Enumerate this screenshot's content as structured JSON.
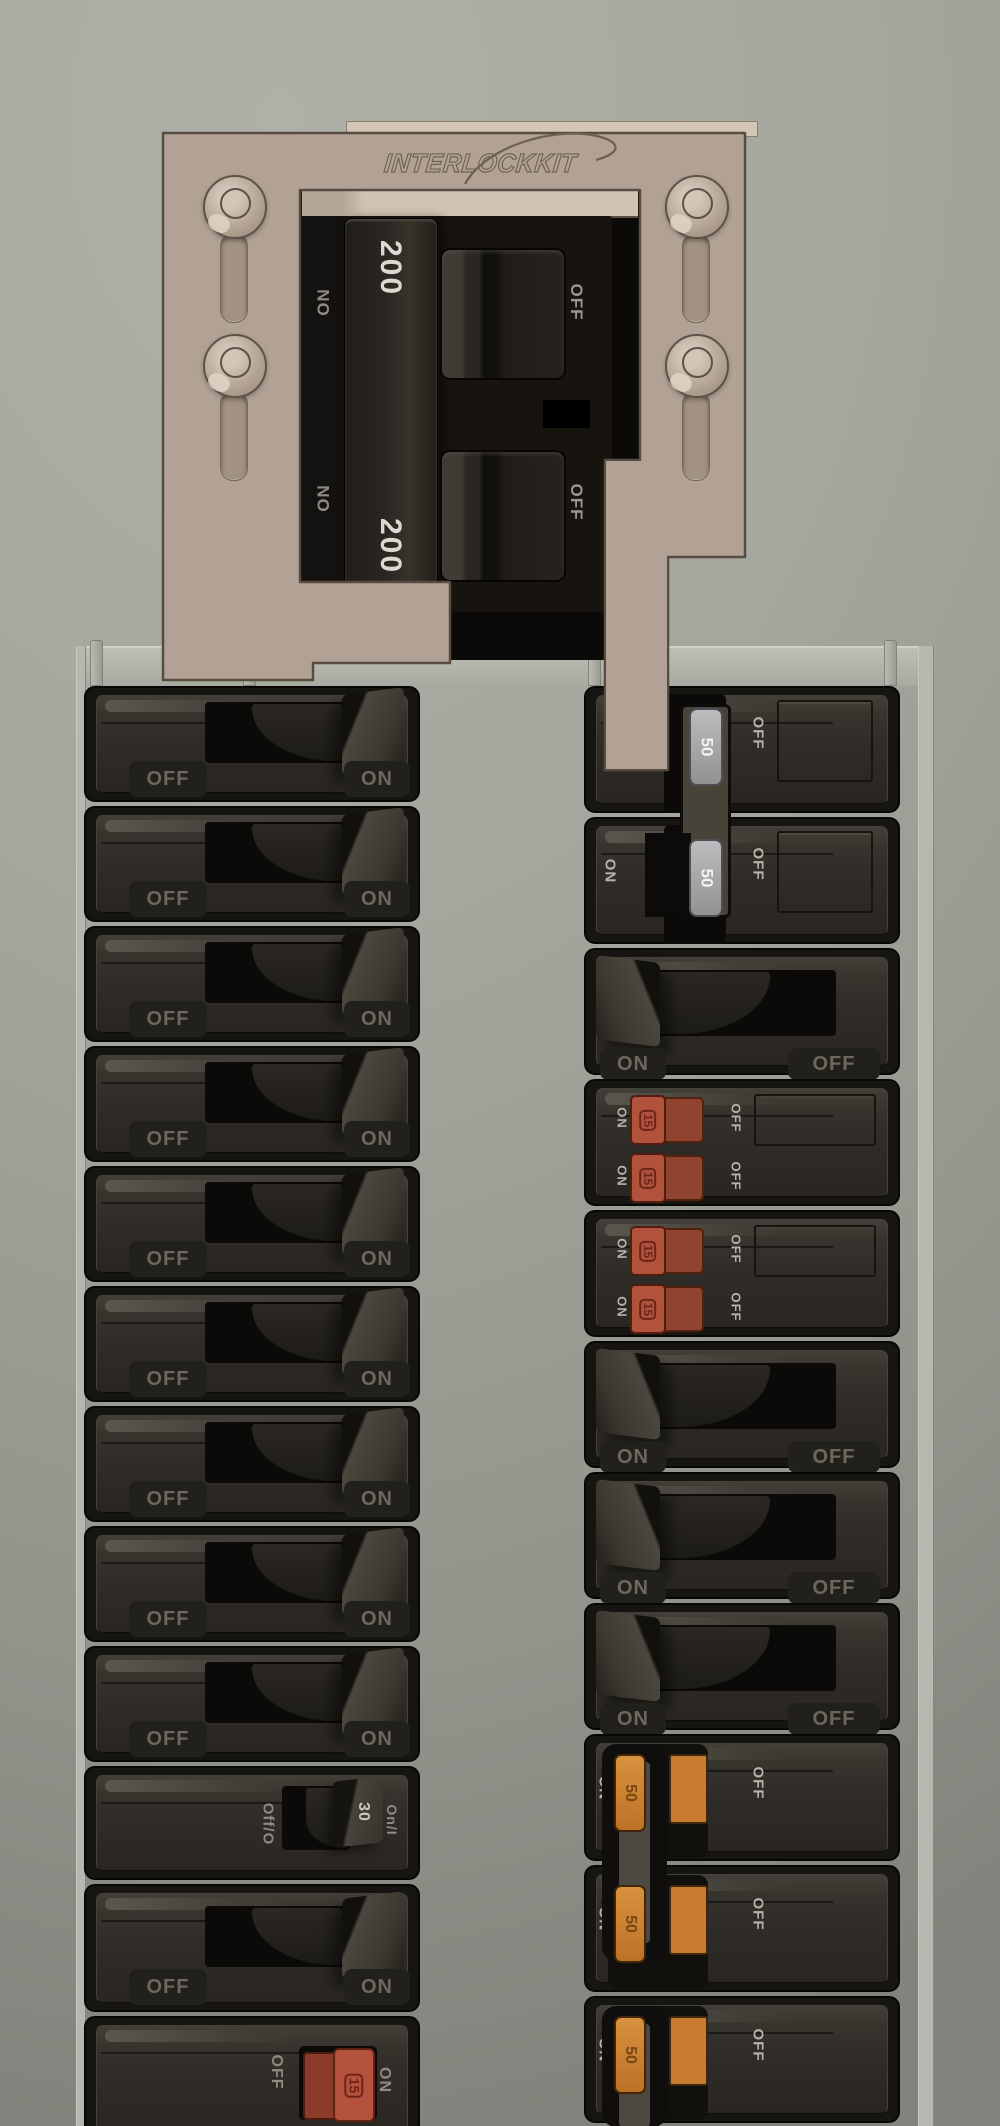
{
  "panel": {
    "interlock_kit": {
      "brand": "INTERLOCKKIT",
      "main_breaker": {
        "pole1": {
          "on": "ON",
          "amps": "200",
          "off": "OFF"
        },
        "pole2": {
          "on": "ON",
          "amps": "200",
          "off": "OFF"
        }
      }
    },
    "left_column": {
      "rows": [
        {
          "type": "single",
          "off": "OFF",
          "on": "ON",
          "state": "on"
        },
        {
          "type": "single",
          "off": "OFF",
          "on": "ON",
          "state": "on"
        },
        {
          "type": "single",
          "off": "OFF",
          "on": "ON",
          "state": "on"
        },
        {
          "type": "single",
          "off": "OFF",
          "on": "ON",
          "state": "on"
        },
        {
          "type": "single",
          "off": "OFF",
          "on": "ON",
          "state": "on"
        },
        {
          "type": "single",
          "off": "OFF",
          "on": "ON",
          "state": "on"
        },
        {
          "type": "single",
          "off": "OFF",
          "on": "ON",
          "state": "on"
        },
        {
          "type": "single",
          "off": "OFF",
          "on": "ON",
          "state": "on"
        },
        {
          "type": "single",
          "off": "OFF",
          "on": "ON",
          "state": "on"
        },
        {
          "type": "special_30a",
          "off": "Off/O",
          "amps": "30",
          "on": "On/I",
          "state": "on"
        },
        {
          "type": "single",
          "off": "OFF",
          "on": "ON",
          "state": "on"
        },
        {
          "type": "red_15a",
          "off": "OFF",
          "amps": "15",
          "on": "ON",
          "state": "on"
        }
      ]
    },
    "right_column": {
      "rows": [
        {
          "type": "two_pole_50a",
          "on": "ON",
          "amps": "50",
          "off": "OFF",
          "state": "off",
          "interlocked": true
        },
        {
          "type": "two_pole_50a",
          "on": "ON",
          "amps": "50",
          "off": "OFF",
          "state": "off"
        },
        {
          "type": "single",
          "on": "ON",
          "off": "OFF",
          "state": "on"
        },
        {
          "type": "tandem_15a",
          "halves": [
            {
              "on": "ON",
              "amps": "15",
              "off": "OFF"
            },
            {
              "on": "ON",
              "amps": "15",
              "off": "OFF"
            }
          ]
        },
        {
          "type": "tandem_15a",
          "halves": [
            {
              "on": "ON",
              "amps": "15",
              "off": "OFF"
            },
            {
              "on": "ON",
              "amps": "15",
              "off": "OFF"
            }
          ]
        },
        {
          "type": "single",
          "on": "ON",
          "off": "OFF",
          "state": "on"
        },
        {
          "type": "single",
          "on": "ON",
          "off": "OFF",
          "state": "on"
        },
        {
          "type": "single",
          "on": "ON",
          "off": "OFF",
          "state": "on"
        },
        {
          "type": "two_pole_50a_orange",
          "on": "ON",
          "amps": "50",
          "off": "OFF",
          "state": "on"
        },
        {
          "type": "two_pole_50a_orange",
          "on": "ON",
          "amps": "50",
          "off": "OFF",
          "state": "on"
        },
        {
          "type": "two_pole_50a_orange",
          "on": "ON",
          "amps": "50",
          "off": "OFF",
          "state": "on"
        }
      ]
    },
    "colors": {
      "plate_tan": "#b2a295",
      "breaker_body": "#171512",
      "gray_handle": "#a7a6a9",
      "orange_handle": "#c87c30",
      "red_handle": "#b5523e",
      "background": "#a4a79e"
    }
  }
}
